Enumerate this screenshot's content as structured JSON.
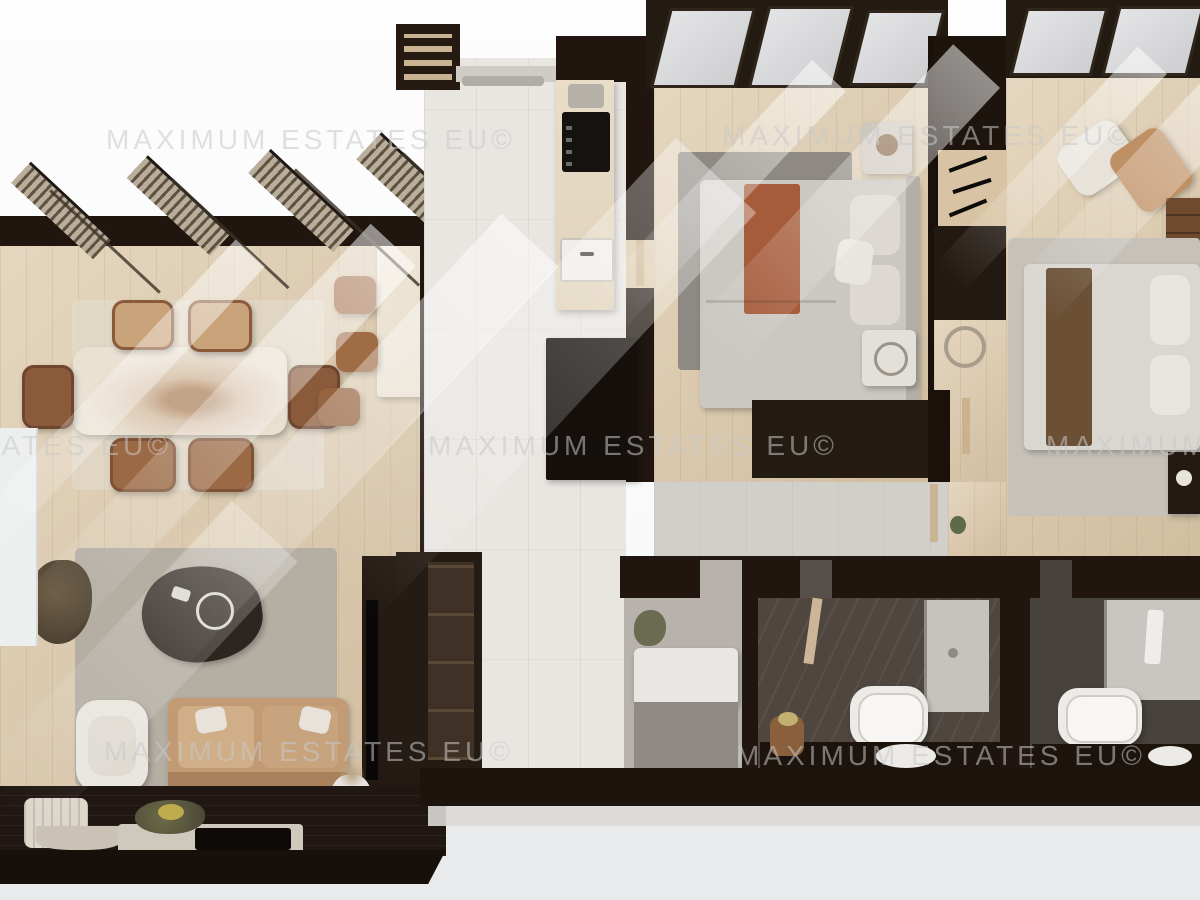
{
  "scene": {
    "type": "3d-top-down-floorplan-render",
    "description": "Photorealistic dollhouse view of a furnished apartment",
    "rooms": [
      {
        "name": "living-dining-area",
        "furniture": [
          "marble dining table",
          "six leather dining chairs",
          "kitchen island with bar stools",
          "tan leather sofa",
          "white armchair",
          "dark coffee table",
          "area rug",
          "tv wall",
          "corner plant",
          "sideboard"
        ]
      },
      {
        "name": "entry-hall-kitchen",
        "furniture": [
          "entry cabinet",
          "coat rail",
          "kitchen counter",
          "cooktop",
          "coffee machine",
          "sink",
          "black storage unit",
          "open wardrobe"
        ]
      },
      {
        "name": "bedroom-main",
        "furniture": [
          "double bed with terracotta runner",
          "two nightstands",
          "gray rug",
          "built-in wardrobe",
          "dark dresser console",
          "hanger rack"
        ]
      },
      {
        "name": "bedroom-second",
        "furniture": [
          "double bed with brown throw",
          "lounge chair",
          "ottoman",
          "dresser",
          "rug",
          "nightstand with lamp"
        ]
      },
      {
        "name": "bathroom-main",
        "furniture": [
          "freestanding bathtub",
          "walk-in shower",
          "vanity with oval sink",
          "wood stool"
        ]
      },
      {
        "name": "bathroom-second",
        "furniture": [
          "bathtub",
          "shower",
          "vanity sink",
          "towel"
        ]
      },
      {
        "name": "laundry-utility-room",
        "furniture": [
          "counter bench",
          "plant"
        ]
      },
      {
        "name": "terrace",
        "furniture": [
          "lounger",
          "curved bench",
          "planters",
          "low table"
        ]
      }
    ]
  },
  "watermark": {
    "text": "MAXIMUM ESTATES EU©"
  },
  "palette": {
    "wood_floor": "#dcc8a9",
    "tile_floor": "#e9e6e2",
    "bath_floor": "#4e463f",
    "walls": "#20160f",
    "sofa_tan": "#c29b75",
    "terracotta_throw": "#a65c3b",
    "bedroom_rug": "#8e8a83",
    "marble": "#eae1d3",
    "background_top": "#fcfcfc",
    "background_bottom": "#e8eaeb"
  }
}
